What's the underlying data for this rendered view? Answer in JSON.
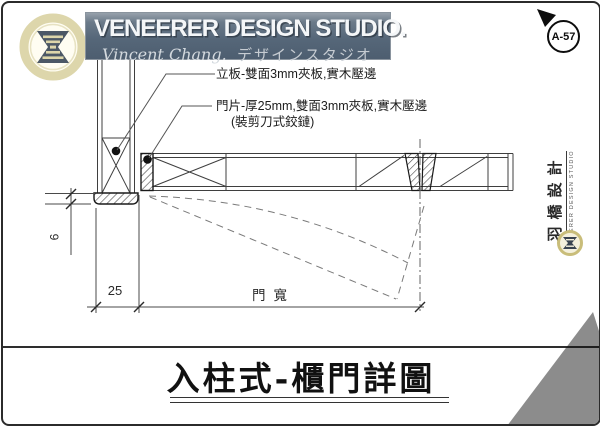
{
  "header": {
    "studio_title": "VENEERER DESIGN STUDIO.",
    "subtitle_script": "Vincent Chang.",
    "subtitle_jp": "デザインスタジオ",
    "page_ref": "A-57"
  },
  "annotations": {
    "upright_panel_note": "立板-雙面3mm夾板,實木壓邊",
    "door_note_line1": "門片-厚25mm,雙面3mm夾板,實木壓邊",
    "door_note_line2": "(裝剪刀式鉸鏈)"
  },
  "dimensions": {
    "edge_band_thickness": "6",
    "frame_width": "25",
    "door_width_label": "門寬"
  },
  "stamp": {
    "studio_name_cn": "羽橋設計",
    "studio_name_en": "VENEERER DESIGN STUDIO"
  },
  "drawing_title": "入柱式-櫃門詳圖",
  "colors": {
    "banner_bg": "#55677a",
    "logo_ring": "#ddd6ab",
    "logo_glyph": "#4c5866",
    "stamp_gold": "#c9bd7a",
    "corner_triangle": "#8c8c8c",
    "drawing_line": "#3f3f3f"
  }
}
